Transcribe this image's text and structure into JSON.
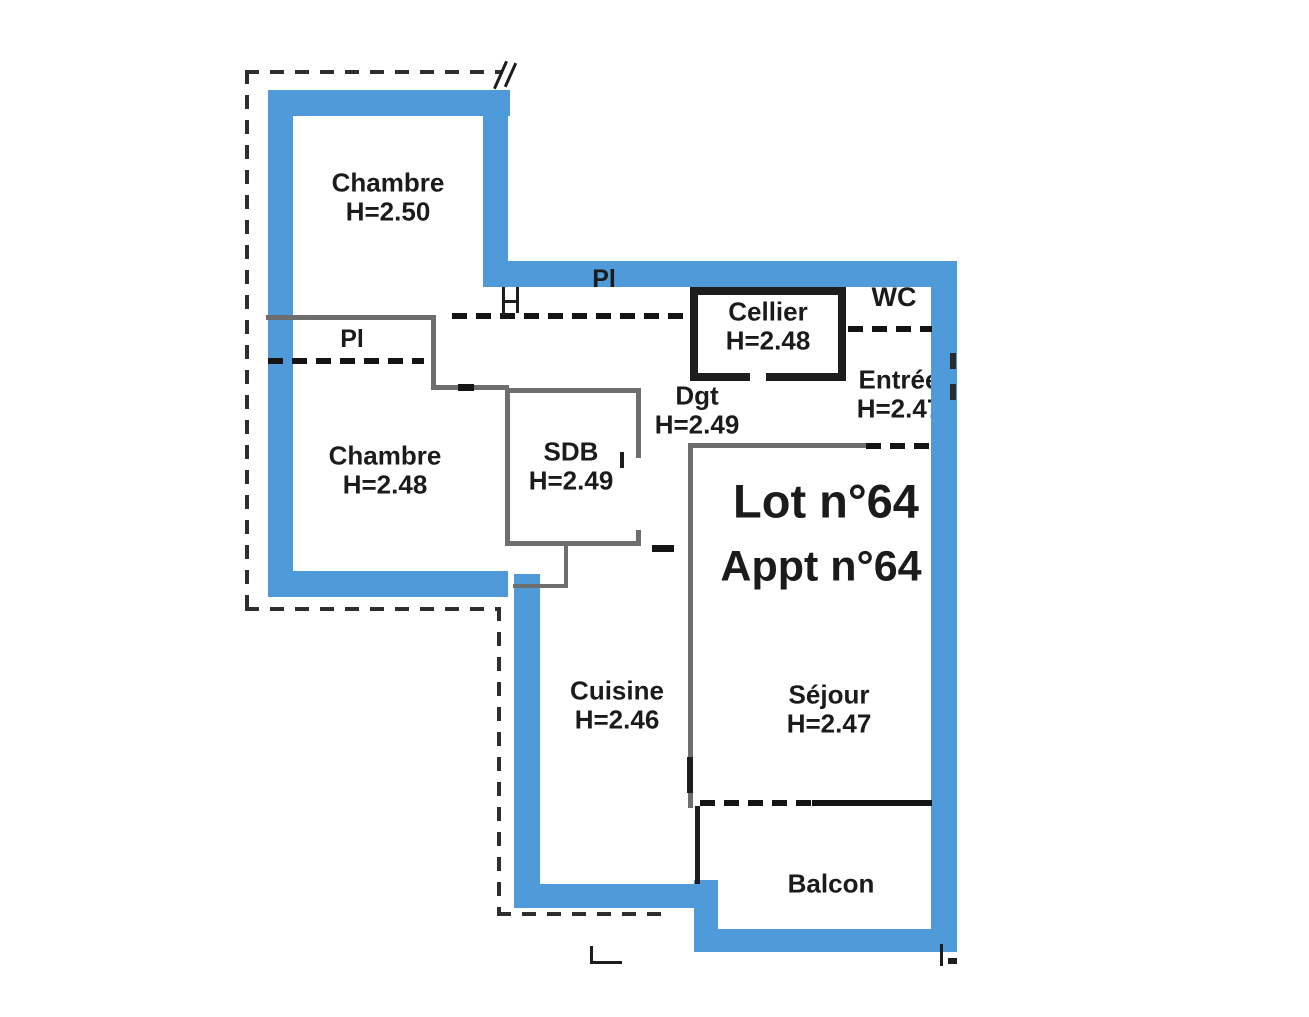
{
  "plan_title": {
    "lot": "Lot n°64",
    "appt": "Appt n°64"
  },
  "rooms": [
    {
      "id": "chambre-1",
      "name": "Chambre",
      "height": "H=2.50"
    },
    {
      "id": "chambre-2",
      "name": "Chambre",
      "height": "H=2.48"
    },
    {
      "id": "sdb",
      "name": "SDB",
      "height": "H=2.49"
    },
    {
      "id": "degagement",
      "name": "Dgt",
      "height": "H=2.49"
    },
    {
      "id": "cellier",
      "name": "Cellier",
      "height": "H=2.48"
    },
    {
      "id": "wc",
      "name": "WC"
    },
    {
      "id": "entree",
      "name": "Entrée",
      "height": "H=2.47"
    },
    {
      "id": "cuisine",
      "name": "Cuisine",
      "height": "H=2.46"
    },
    {
      "id": "sejour",
      "name": "Séjour",
      "height": "H=2.47"
    },
    {
      "id": "balcon",
      "name": "Balcon"
    }
  ],
  "closets": [
    {
      "label": "Pl"
    },
    {
      "label": "Pl"
    }
  ],
  "colors": {
    "wall_blue": "#4f9ad9",
    "line_dark": "#1d1d1d",
    "line_gray": "#6e6e6e",
    "text": "#1b1b1b",
    "background": "#ffffff"
  }
}
